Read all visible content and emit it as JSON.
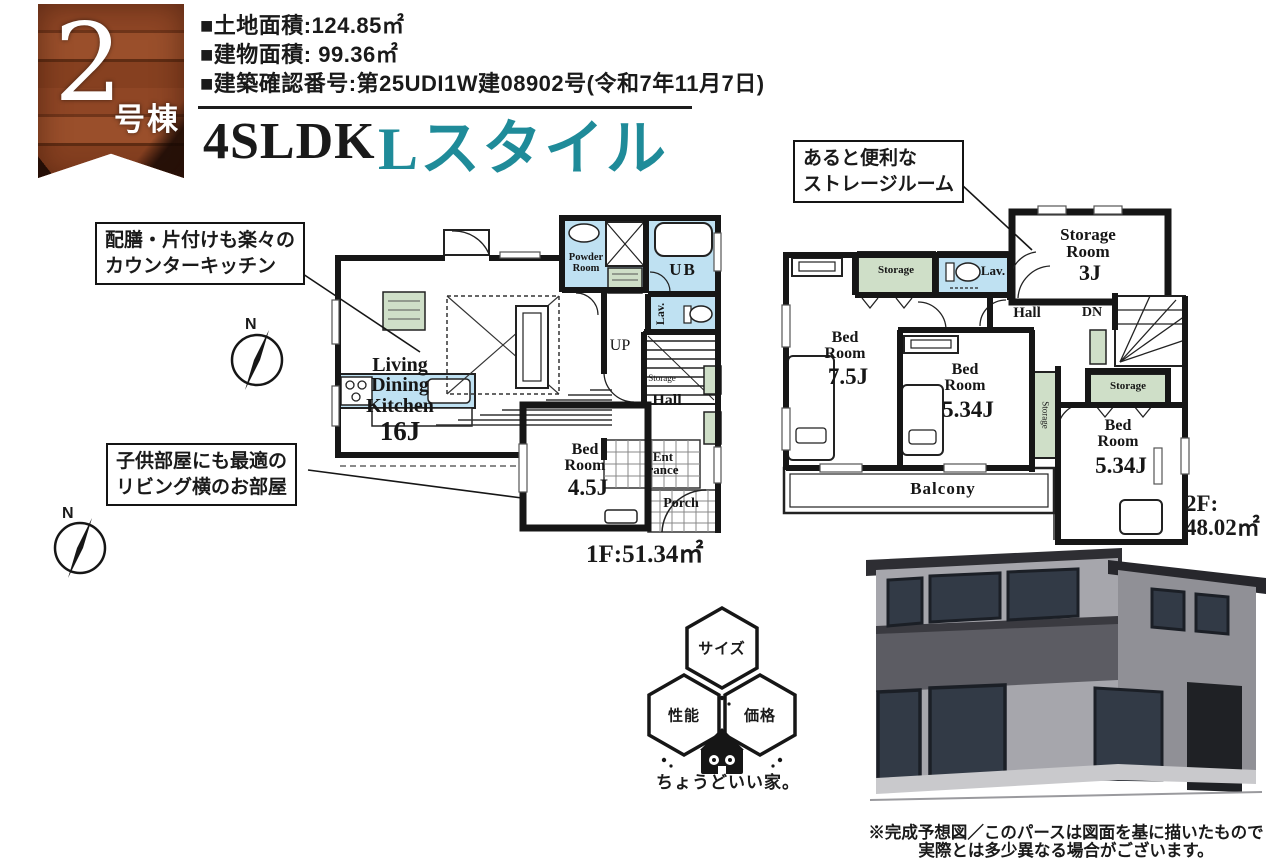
{
  "badge": {
    "number": "2",
    "label": "号棟"
  },
  "specs": {
    "land": "■土地面積:124.85㎡",
    "building": "■建物面積: 99.36㎡",
    "permit": "■建築確認番号:第25UDI1W建08902号(令和7年11月7日)"
  },
  "title": {
    "plan_type": "4SLDK",
    "style_name": "Lスタイル"
  },
  "callouts": {
    "kitchen": "配膳・片付けも楽々の\nカウンターキッチン",
    "kids_room": "子供部屋にも最適の\nリビング横のお部屋",
    "storage": "あると便利な\nストレージルーム"
  },
  "compass": {
    "north": "N"
  },
  "floor1": {
    "area": "1F:51.34㎡",
    "rooms": {
      "ldk": "Living\nDining\nKitchen",
      "ldk_size": "16J",
      "bedroom": "Bed\nRoom",
      "bedroom_size": "4.5J",
      "powder": "Powder\nRoom",
      "bath": "UB",
      "lavatory": "Lav.",
      "stairs": "UP",
      "storage": "Storage",
      "hall": "Hall",
      "entrance": "Ent\nrance",
      "porch": "Porch"
    }
  },
  "floor2": {
    "area": "2F:\n48.02㎡",
    "rooms": {
      "storage_room": "Storage\nRoom",
      "storage_room_size": "3J",
      "storage_top": "Storage",
      "lavatory": "Lav.",
      "hall": "Hall",
      "stairs": "DN",
      "bedroom1": "Bed\nRoom",
      "bedroom1_size": "7.5J",
      "bedroom2": "Bed\nRoom",
      "bedroom2_size": "5.34J",
      "storage_mid": "Storage",
      "storage_right": "Storage",
      "bedroom3": "Bed\nRoom",
      "bedroom3_size": "5.34J",
      "balcony": "Balcony"
    }
  },
  "logo": {
    "hex_top": "サイズ",
    "hex_left": "性能",
    "hex_right": "価格",
    "tagline": "ちょうどいい家。"
  },
  "colors": {
    "accent_teal": "#1f8b99",
    "wet_area_blue": "#bfe1f2",
    "storage_green": "#cfdfc8"
  },
  "disclaimer": "※完成予想図／このパースは図面を基に描いたもので\n実際とは多少異なる場合がございます。"
}
